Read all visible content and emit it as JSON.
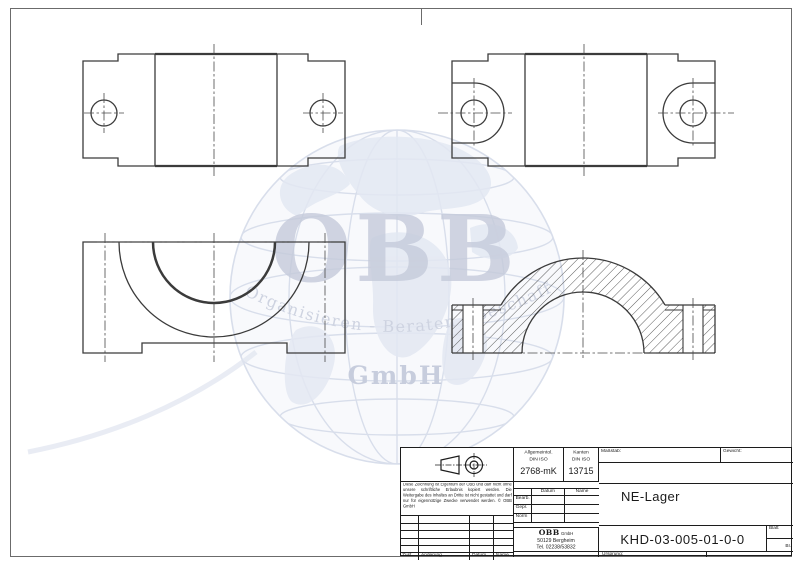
{
  "title_block": {
    "general_tolerance": {
      "line1": "Allgemeintol.",
      "line2": "DIN ISO",
      "value": "2768-mK"
    },
    "edges": {
      "line1": "Kanten",
      "line2": "DIN ISO",
      "value": "13715"
    },
    "scale_label": "Maßstab:",
    "weight_label": "Gewicht:",
    "part_title": "NE-Lager",
    "drawing_number": "KHD-03-005-01-0-0",
    "sheet_label": "Blatt",
    "sheet_abbr": "Bl.",
    "origin_label": "Ursprung:",
    "disclaimer": "Diese Zeichnung ist Eigentum der OBB und darf nicht ohne unsere schriftliche Erlaubnis kopiert werden. Die Weitergabe des Inhaltes an Dritte ist nicht gestattet und darf nur für eigennützige Zwecke verwendet werden. © OBB GmbH",
    "approval": {
      "col_datum": "Datum",
      "col_name": "Name",
      "row_bearb": "Bearb.",
      "row_gepr": "Gepr.",
      "row_norm": "Norm"
    },
    "revision": {
      "col_zust": "Zust.",
      "col_aenderung": "Änderung",
      "col_datum": "Datum",
      "col_name": "Name"
    },
    "company": {
      "name": "OBB",
      "legal": "GmbH",
      "city": "50129 Bergheim",
      "phone": "Tel. 02238/53832"
    }
  },
  "watermark": {
    "logo": "OBB",
    "tagline": "Organisieren - Beraten - Beschaffen",
    "legal": "GmbH",
    "color": "#96a0bd"
  },
  "drawing": {
    "part": "NE-Lager",
    "line_color": "#3b3b3b",
    "views": "top-view, bottom-view, front-view, section-view"
  }
}
